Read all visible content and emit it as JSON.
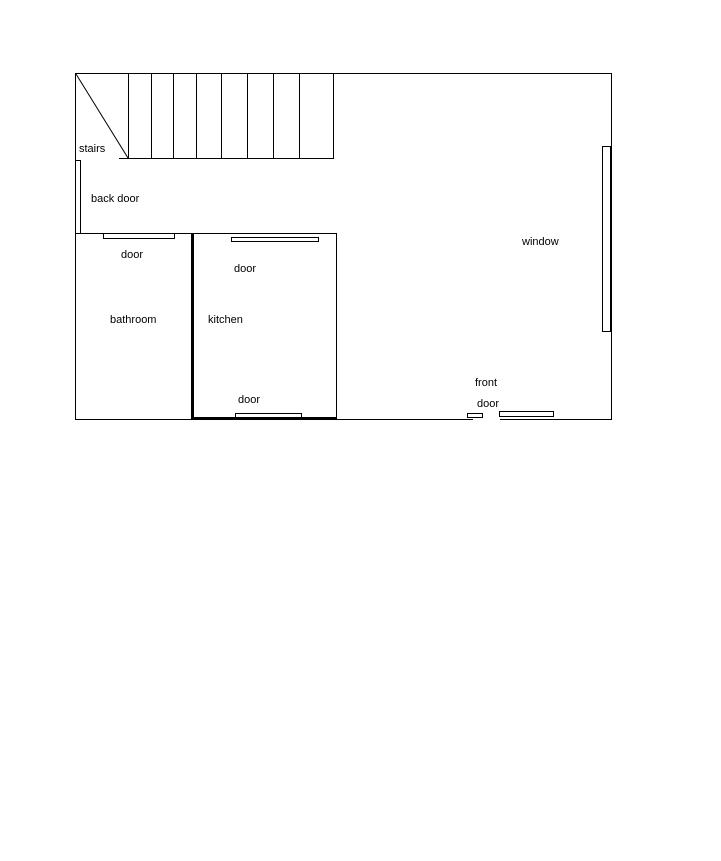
{
  "floorplan": {
    "labels": {
      "stairs": "stairs",
      "back_door": "back door",
      "bathroom_door": "door",
      "bathroom": "bathroom",
      "kitchen": "kitchen",
      "kitchen_top_door": "door",
      "kitchen_bottom_door": "door",
      "window": "window",
      "front_door_line1": "front",
      "front_door_line2": "door"
    },
    "colors": {
      "line": "#000000",
      "background": "#ffffff"
    }
  }
}
